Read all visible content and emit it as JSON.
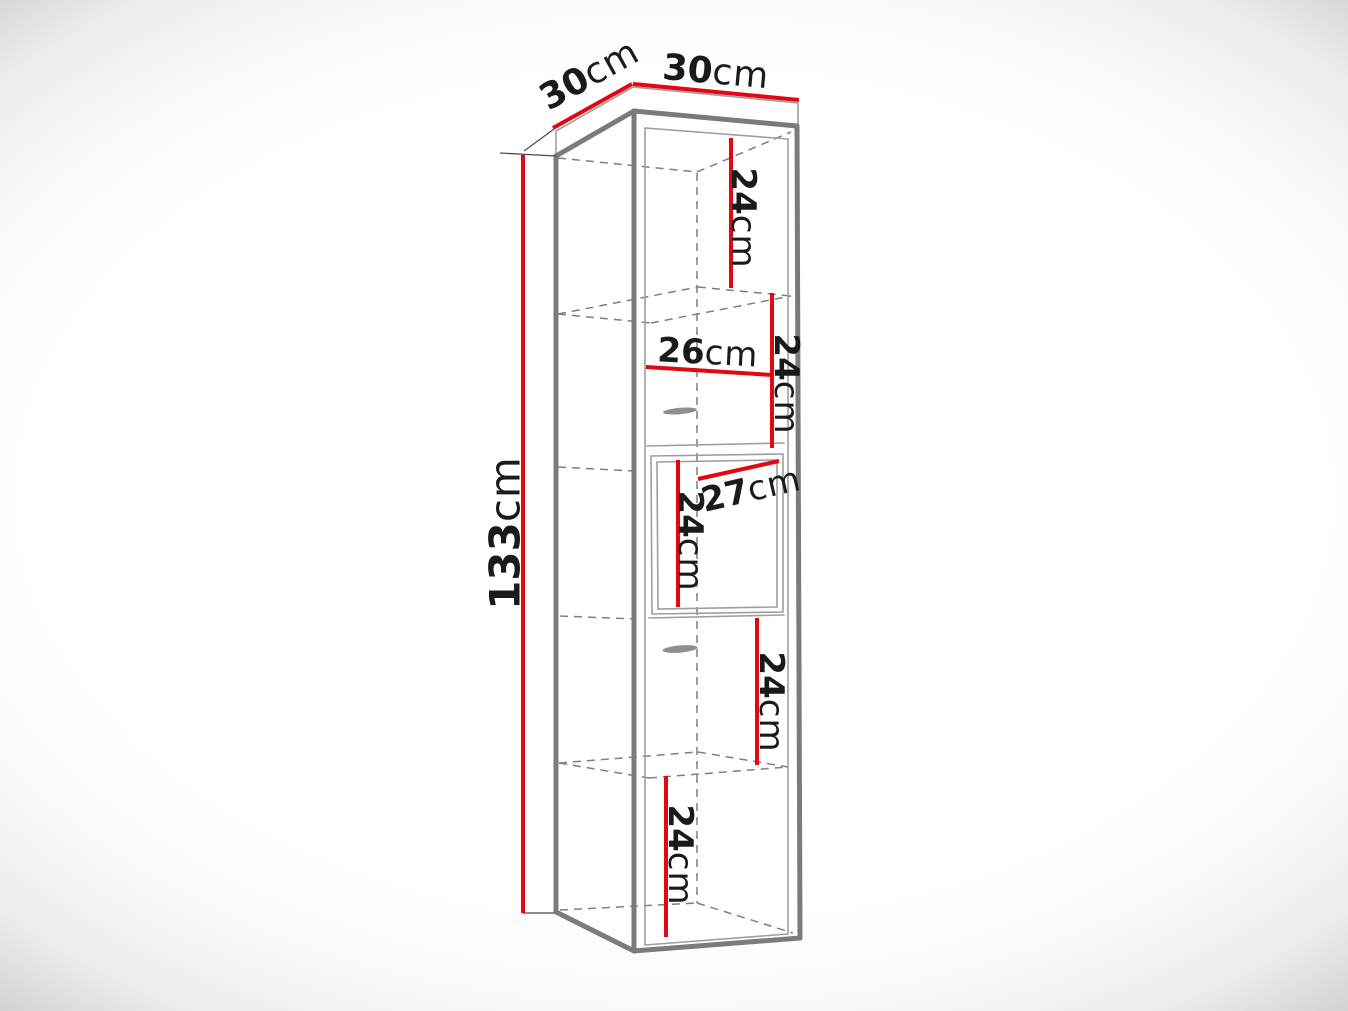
{
  "figure": {
    "type": "furniture-dimension-diagram",
    "unit": "cm",
    "colors": {
      "dimension_red": "#e30613",
      "outline_gray": "#7b7b7b",
      "hidden_line_gray": "#7f7f7f",
      "label_black": "#1a1a1a"
    }
  },
  "dimensions": {
    "depth_top": {
      "value": "30",
      "unit": "cm"
    },
    "width_top": {
      "value": "30",
      "unit": "cm"
    },
    "height_total": {
      "value": "133",
      "unit": "cm"
    },
    "compartment_1": {
      "value": "24",
      "unit": "cm"
    },
    "compartment_2": {
      "value": "24",
      "unit": "cm"
    },
    "inner_width": {
      "value": "26",
      "unit": "cm"
    },
    "compartment_3": {
      "value": "24",
      "unit": "cm"
    },
    "shelf_depth": {
      "value": "27",
      "unit": "cm"
    },
    "compartment_4": {
      "value": "24",
      "unit": "cm"
    },
    "compartment_5": {
      "value": "24",
      "unit": "cm"
    }
  }
}
